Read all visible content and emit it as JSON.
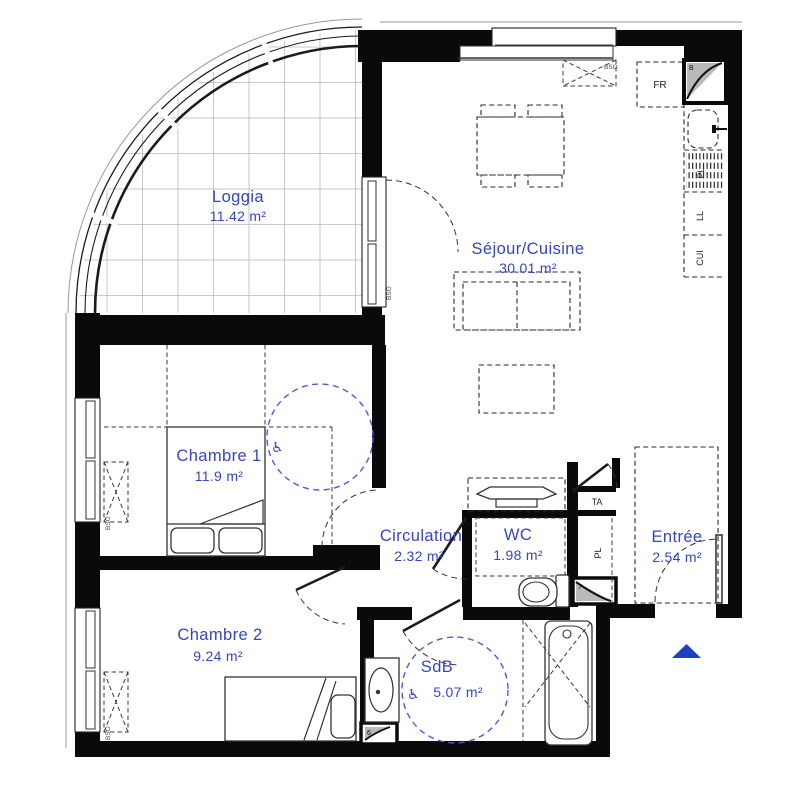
{
  "plan_title": "Floor plan (apartment)",
  "colors": {
    "label_blue": "#3546c0",
    "circle_blue": "#4c5cd4",
    "wall_black": "#0a0a0a",
    "shaft_gray": "#b9b9b9",
    "triangle_blue": "#1d3fc1"
  },
  "rooms": {
    "loggia": {
      "name": "Loggia",
      "area": "11.42 m²"
    },
    "sejour": {
      "name": "Séjour/Cuisine",
      "area": "30.01 m²"
    },
    "chambre1": {
      "name": "Chambre 1",
      "area": "11.9 m²"
    },
    "circulation": {
      "name": "Circulation",
      "area": "2.32 m²"
    },
    "wc": {
      "name": "WC",
      "area": "1.98 m²"
    },
    "entree": {
      "name": "Entrée",
      "area": "2.54 m²"
    },
    "chambre2": {
      "name": "Chambre 2",
      "area": "9.24 m²"
    },
    "sdb": {
      "name": "SdB",
      "area": "5.07 m²"
    }
  },
  "fixtures": {
    "fridge": "FR",
    "panel": "TA",
    "closet": "PL",
    "kitchen_unit": "PL",
    "washing_machine": "LL",
    "cooker": "CUI",
    "shaft_b": "B",
    "shaft_7": "7",
    "shaft_6": "6",
    "blind": "BSO"
  },
  "symbols": {
    "accessible": "♿"
  }
}
